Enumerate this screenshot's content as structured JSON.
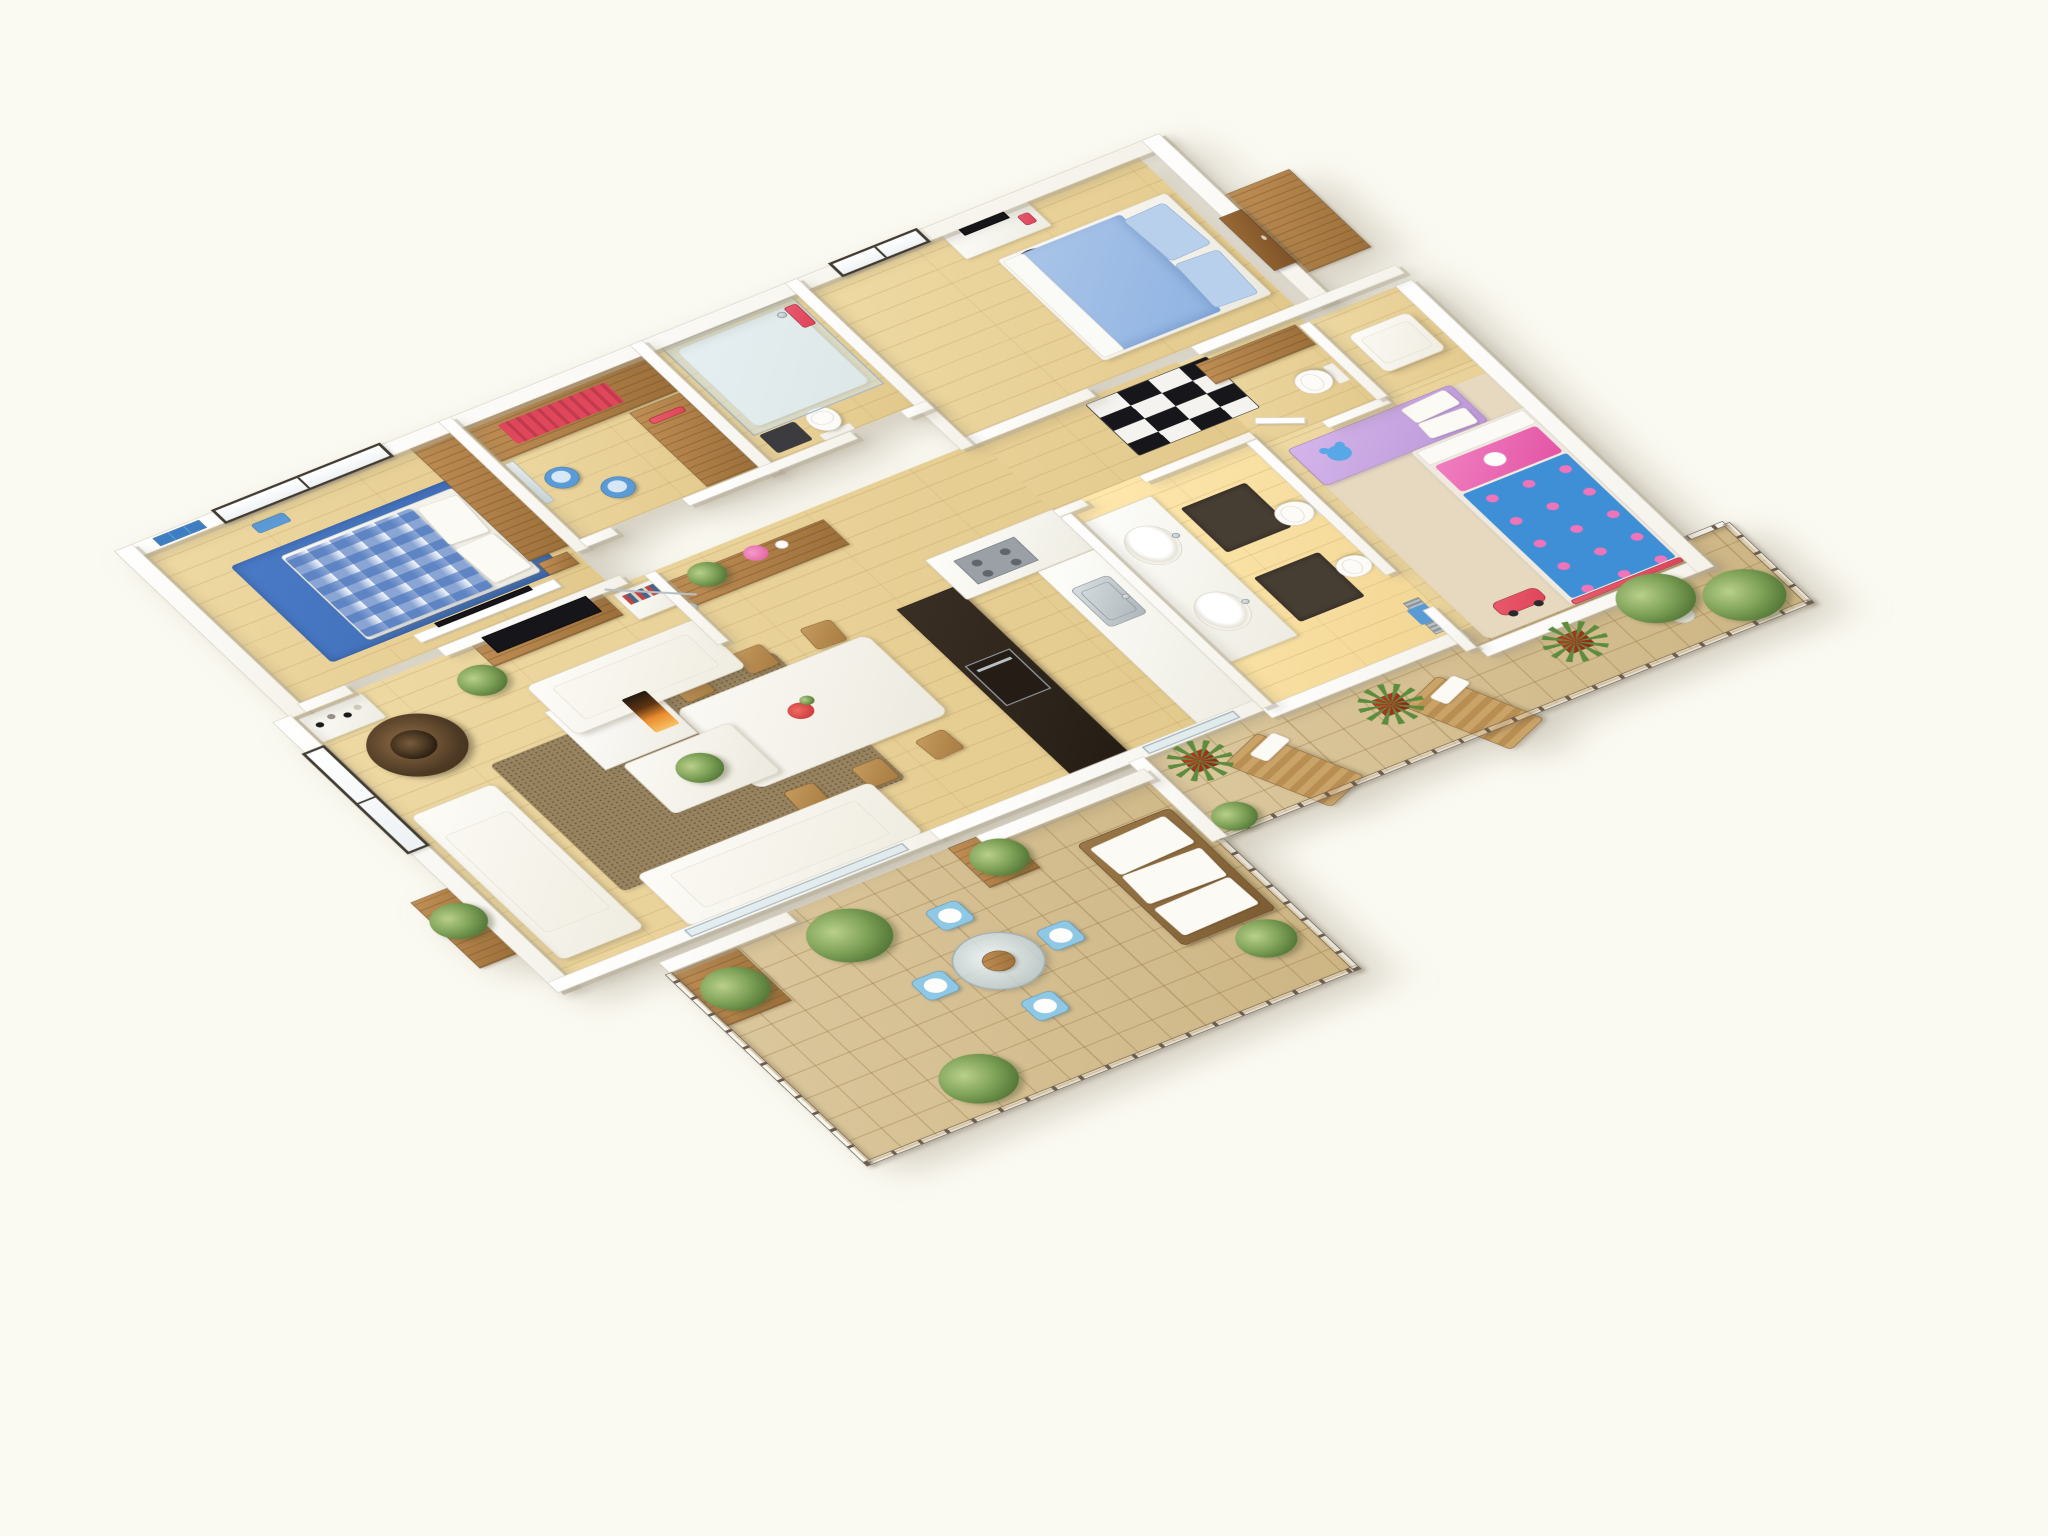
{
  "scene": {
    "type": "3d-floor-plan-render",
    "style": "isometric dollhouse cutaway of a 3-bedroom apartment, viewed from above",
    "background": "#fbfaf2",
    "visible_text": []
  },
  "palette": {
    "bg": "#fbfaf2",
    "wall": "#ffffff",
    "wallEdge": "#d8d3c6",
    "floorWood": "#efdaa4",
    "floorWoodDark": "#e2c88b",
    "tileA": "#dcc89e",
    "tileB": "#cdb584",
    "woodA": "#c08f55",
    "woodB": "#9c6f3a",
    "woodEdge": "#7c5a33",
    "kitchenDark": "#241c14",
    "steel": "#aeb6ba",
    "furnWhite": "#f7f4ec",
    "ginghamBlue": "#4a7cc4",
    "royalBlue": "#3d6cb4",
    "bedroomBlue": "#8fb3e2",
    "kidsBlue": "#3f8fd6",
    "pink": "#ec63b2",
    "lilac": "#bb97d9",
    "red": "#df4459",
    "stoolBlue": "#5b9bd5",
    "shagBrown": "#97835f",
    "rugDark": "#463d33",
    "rugBeige": "#e6d9bf",
    "leafGreen": "#6f9150",
    "rattan": "#8a6a42",
    "fireOrange": "#f0953c",
    "terraceBlue": "#8fc8e4",
    "railBrown": "#6b5d50"
  },
  "rooms": {
    "master_bedroom": {
      "name": "Master bedroom",
      "items": [
        "double bed with blue gingham duvet",
        "white pillows",
        "royal blue area rug",
        "sliding wood wardrobe",
        "TV on half wall",
        "sliding window",
        "blue wall art",
        "blue bench",
        "nightstand"
      ]
    },
    "walk_in_closet": {
      "name": "Walk-in closet",
      "items": [
        "wardrobe with red hanging clothes",
        "wooden shelving unit",
        "two blue stools",
        "mirror"
      ]
    },
    "shower_room": {
      "name": "Shower room",
      "items": [
        "glass walk-in shower",
        "toilet",
        "dark mat",
        "red towels"
      ]
    },
    "bedroom_2": {
      "name": "Bedroom 2",
      "items": [
        "double bed with light blue duvet",
        "blue pillows",
        "computer desk with monitor",
        "office chair",
        "window",
        "black and white diamond rug",
        "wooden entry door"
      ]
    },
    "kids_bathroom": {
      "name": "Small bathroom",
      "items": [
        "toilet",
        "wooden cabinet",
        "door"
      ]
    },
    "kids_bedroom": {
      "name": "Kids bedroom",
      "items": [
        "single bed with blue polka-dot duvet",
        "pink pillow with cartoon",
        "lilac bench with white cushions",
        "blue teddy bear",
        "white armchair",
        "beige rug",
        "red toy car"
      ]
    },
    "main_bathroom": {
      "name": "Main bathroom",
      "items": [
        "double sink vanity",
        "two dark rugs",
        "toilet",
        "bidet",
        "chrome towel radiator with blue towel"
      ]
    },
    "kitchen": {
      "name": "Kitchen",
      "items": [
        "dark tall unit with steel oven",
        "counter with cooktop",
        "counter with steel sink"
      ]
    },
    "dining_area": {
      "name": "Dining area",
      "items": [
        "white dining table",
        "six wooden chairs",
        "red flower centerpiece",
        "wooden sideboard",
        "potted plant",
        "pink flowers"
      ]
    },
    "living_room": {
      "name": "Living room",
      "items": [
        "three white sofas",
        "brown shag rug",
        "white coffee table with plant",
        "TV on wooden stand",
        "rattan egg chair",
        "arc floor lamp",
        "cube shelf with books",
        "wall shelf with vases",
        "window",
        "fireplace"
      ]
    },
    "hallway": {
      "name": "Hallway",
      "items": [
        "black and white geometric rug"
      ]
    },
    "terrace": {
      "name": "Terrace",
      "items": [
        "round glass table",
        "four light blue chairs",
        "rattan sofa with white cushions",
        "wooden planter boxes",
        "green bushes",
        "topiary in white pot",
        "metal railing"
      ]
    },
    "balcony": {
      "name": "Balcony",
      "items": [
        "two wooden sun loungers",
        "palms in red pots",
        "two round topiary trees in white pots",
        "green bush",
        "metal railing"
      ]
    },
    "entry": {
      "name": "Entry",
      "items": [
        "wooden front door",
        "wooden landing"
      ]
    }
  }
}
